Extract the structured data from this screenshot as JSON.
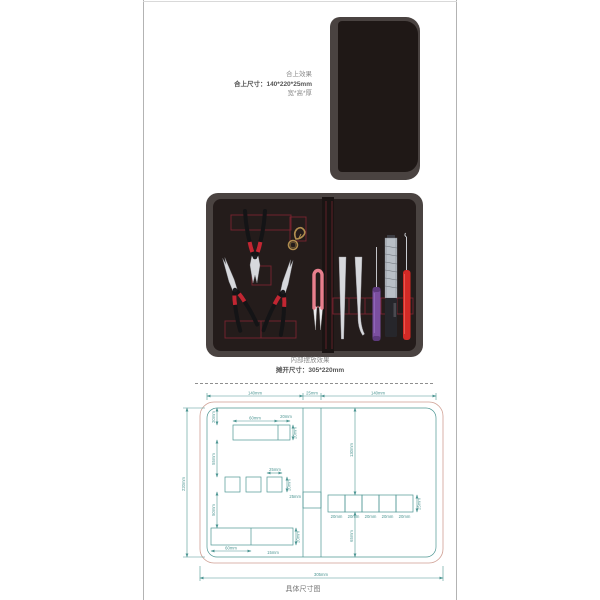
{
  "colors": {
    "frame_line": "#b3b3b3",
    "case_rim": "#4a4341",
    "case_front": "#1f1816",
    "case_inner": "#241c1b",
    "stitch": "#7a2430",
    "teal": "#4d9693",
    "salmon": "#cf9f93",
    "metal": "#d7d8dc",
    "handle_black": "#141416",
    "band_red": "#c22632",
    "snips_pink": "#e87f8d",
    "purple": "#7b4fa0",
    "knife_steel": "#b9bfc6",
    "knife_body": "#26262b",
    "hook_red": "#d32a26",
    "gold": "#b08d4f",
    "text_gray": "#8c8c8c",
    "text_dark": "#555555"
  },
  "closed_view": {
    "heading": "合上效果",
    "size_line": "合上尺寸：140*220*25mm",
    "unit_line": "宽*高*厚"
  },
  "open_view": {
    "caption": "内部摆放效果",
    "size_line": "摊开尺寸：305*220mm"
  },
  "drawing": {
    "title": "具体尺寸图",
    "dims": {
      "top_left": "140mm",
      "top_spine": "25mm",
      "top_right": "140mm",
      "side_height": "220mm",
      "bottom_width": "305mm",
      "lp_top_a": "60mm",
      "lp_top_b": "20mm",
      "lp_top_h": "20mm",
      "lp_v_top": "20mm",
      "lp_v_mid": "55mm",
      "lp_v_bot": "50mm",
      "lp_sq_w": "25mm",
      "lp_sq_h": "20mm",
      "spine_pocket_h": "25mm",
      "lp_bot_a": "60mm",
      "lp_bot_h": "20mm",
      "lp_bot_off": "15mm",
      "rp_v_top": "130mm",
      "rp_v_bot": "65mm",
      "rp_cell": "20mm",
      "rp_cell_h": "25mm"
    }
  }
}
